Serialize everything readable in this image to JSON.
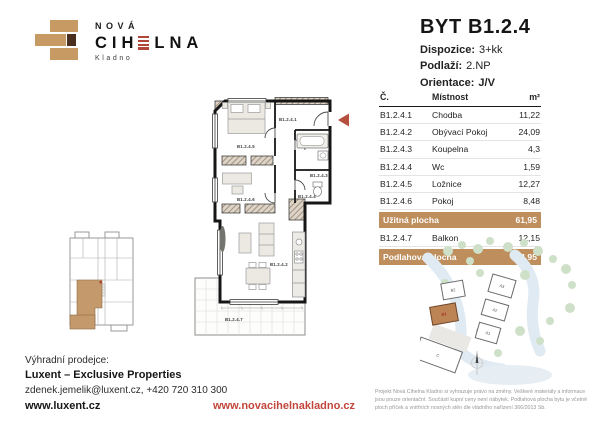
{
  "logo": {
    "name_top": "NOVÁ",
    "name_pre": "CIH",
    "name_post": "LNA",
    "city": "Kladno"
  },
  "header": {
    "title": "BYT B1.2.4",
    "specs": [
      {
        "label": "Dispozice:",
        "value": "3+kk"
      },
      {
        "label": "Podlaží:",
        "value": "2.NP"
      },
      {
        "label": "Orientace:",
        "value": "J/V"
      }
    ]
  },
  "table": {
    "col_number": "Č.",
    "col_room": "Místnost",
    "col_area": "m²",
    "rows": [
      {
        "no": "B1.2.4.1",
        "room": "Chodba",
        "area": "11,22"
      },
      {
        "no": "B1.2.4.2",
        "room": "Obývací Pokoj",
        "area": "24,09"
      },
      {
        "no": "B1.2.4.3",
        "room": "Koupelna",
        "area": "4,3"
      },
      {
        "no": "B1.2.4.4",
        "room": "Wc",
        "area": "1,59"
      },
      {
        "no": "B1.2.4.5",
        "room": "Ložnice",
        "area": "12,27"
      },
      {
        "no": "B1.2.4.6",
        "room": "Pokoj",
        "area": "8,48"
      }
    ],
    "usable": {
      "label": "Užitná plocha",
      "area": "61,95"
    },
    "balcony_row": {
      "no": "B1.2.4.7",
      "room": "Balkon",
      "area": "12,15"
    },
    "floor_total": {
      "label": "Podlahová plocha",
      "area": "64,95"
    }
  },
  "floorplan": {
    "labels": {
      "r1": "B1.2.4.1",
      "r2": "B1.2.4.2",
      "r3": "B1.2.4.3",
      "r4": "B1.2.4.4",
      "r5": "B1.2.4.5",
      "r6": "B1.2.4.6",
      "r7": "B1.2.4.7"
    }
  },
  "site_plan": {
    "buildings": {
      "b2": "B2",
      "b1": "B1",
      "a3": "A3",
      "a2": "A2",
      "a1": "A1",
      "c": "C"
    },
    "highlighted": "B1"
  },
  "footer": {
    "seller_label": "Výhradní prodejce:",
    "seller_name": "Luxent – Exclusive Properties",
    "contact": "zdenek.jemelik@luxent.cz, +420 720 310 300",
    "seller_web": "www.luxent.cz",
    "project_web": "www.novacihelnakladno.cz",
    "disclaimer": "Projekt Nová Cihelna Kladno si vyhrazuje právo na změny. Veškeré materiály a informace jsou pouze orientační. Součástí kupní ceny není nábytek. Podlahová plocha bytu je včetně ploch příček a vnitřních nosných stěn dle vládního nařízení 366/2013 Sb."
  },
  "colors": {
    "brick_tan": "#C79A63",
    "table_highlight": "#BE8E5C",
    "accent_red": "#B5503F",
    "link_red": "#C2463C",
    "brick_dark": "#4A2E1E"
  }
}
